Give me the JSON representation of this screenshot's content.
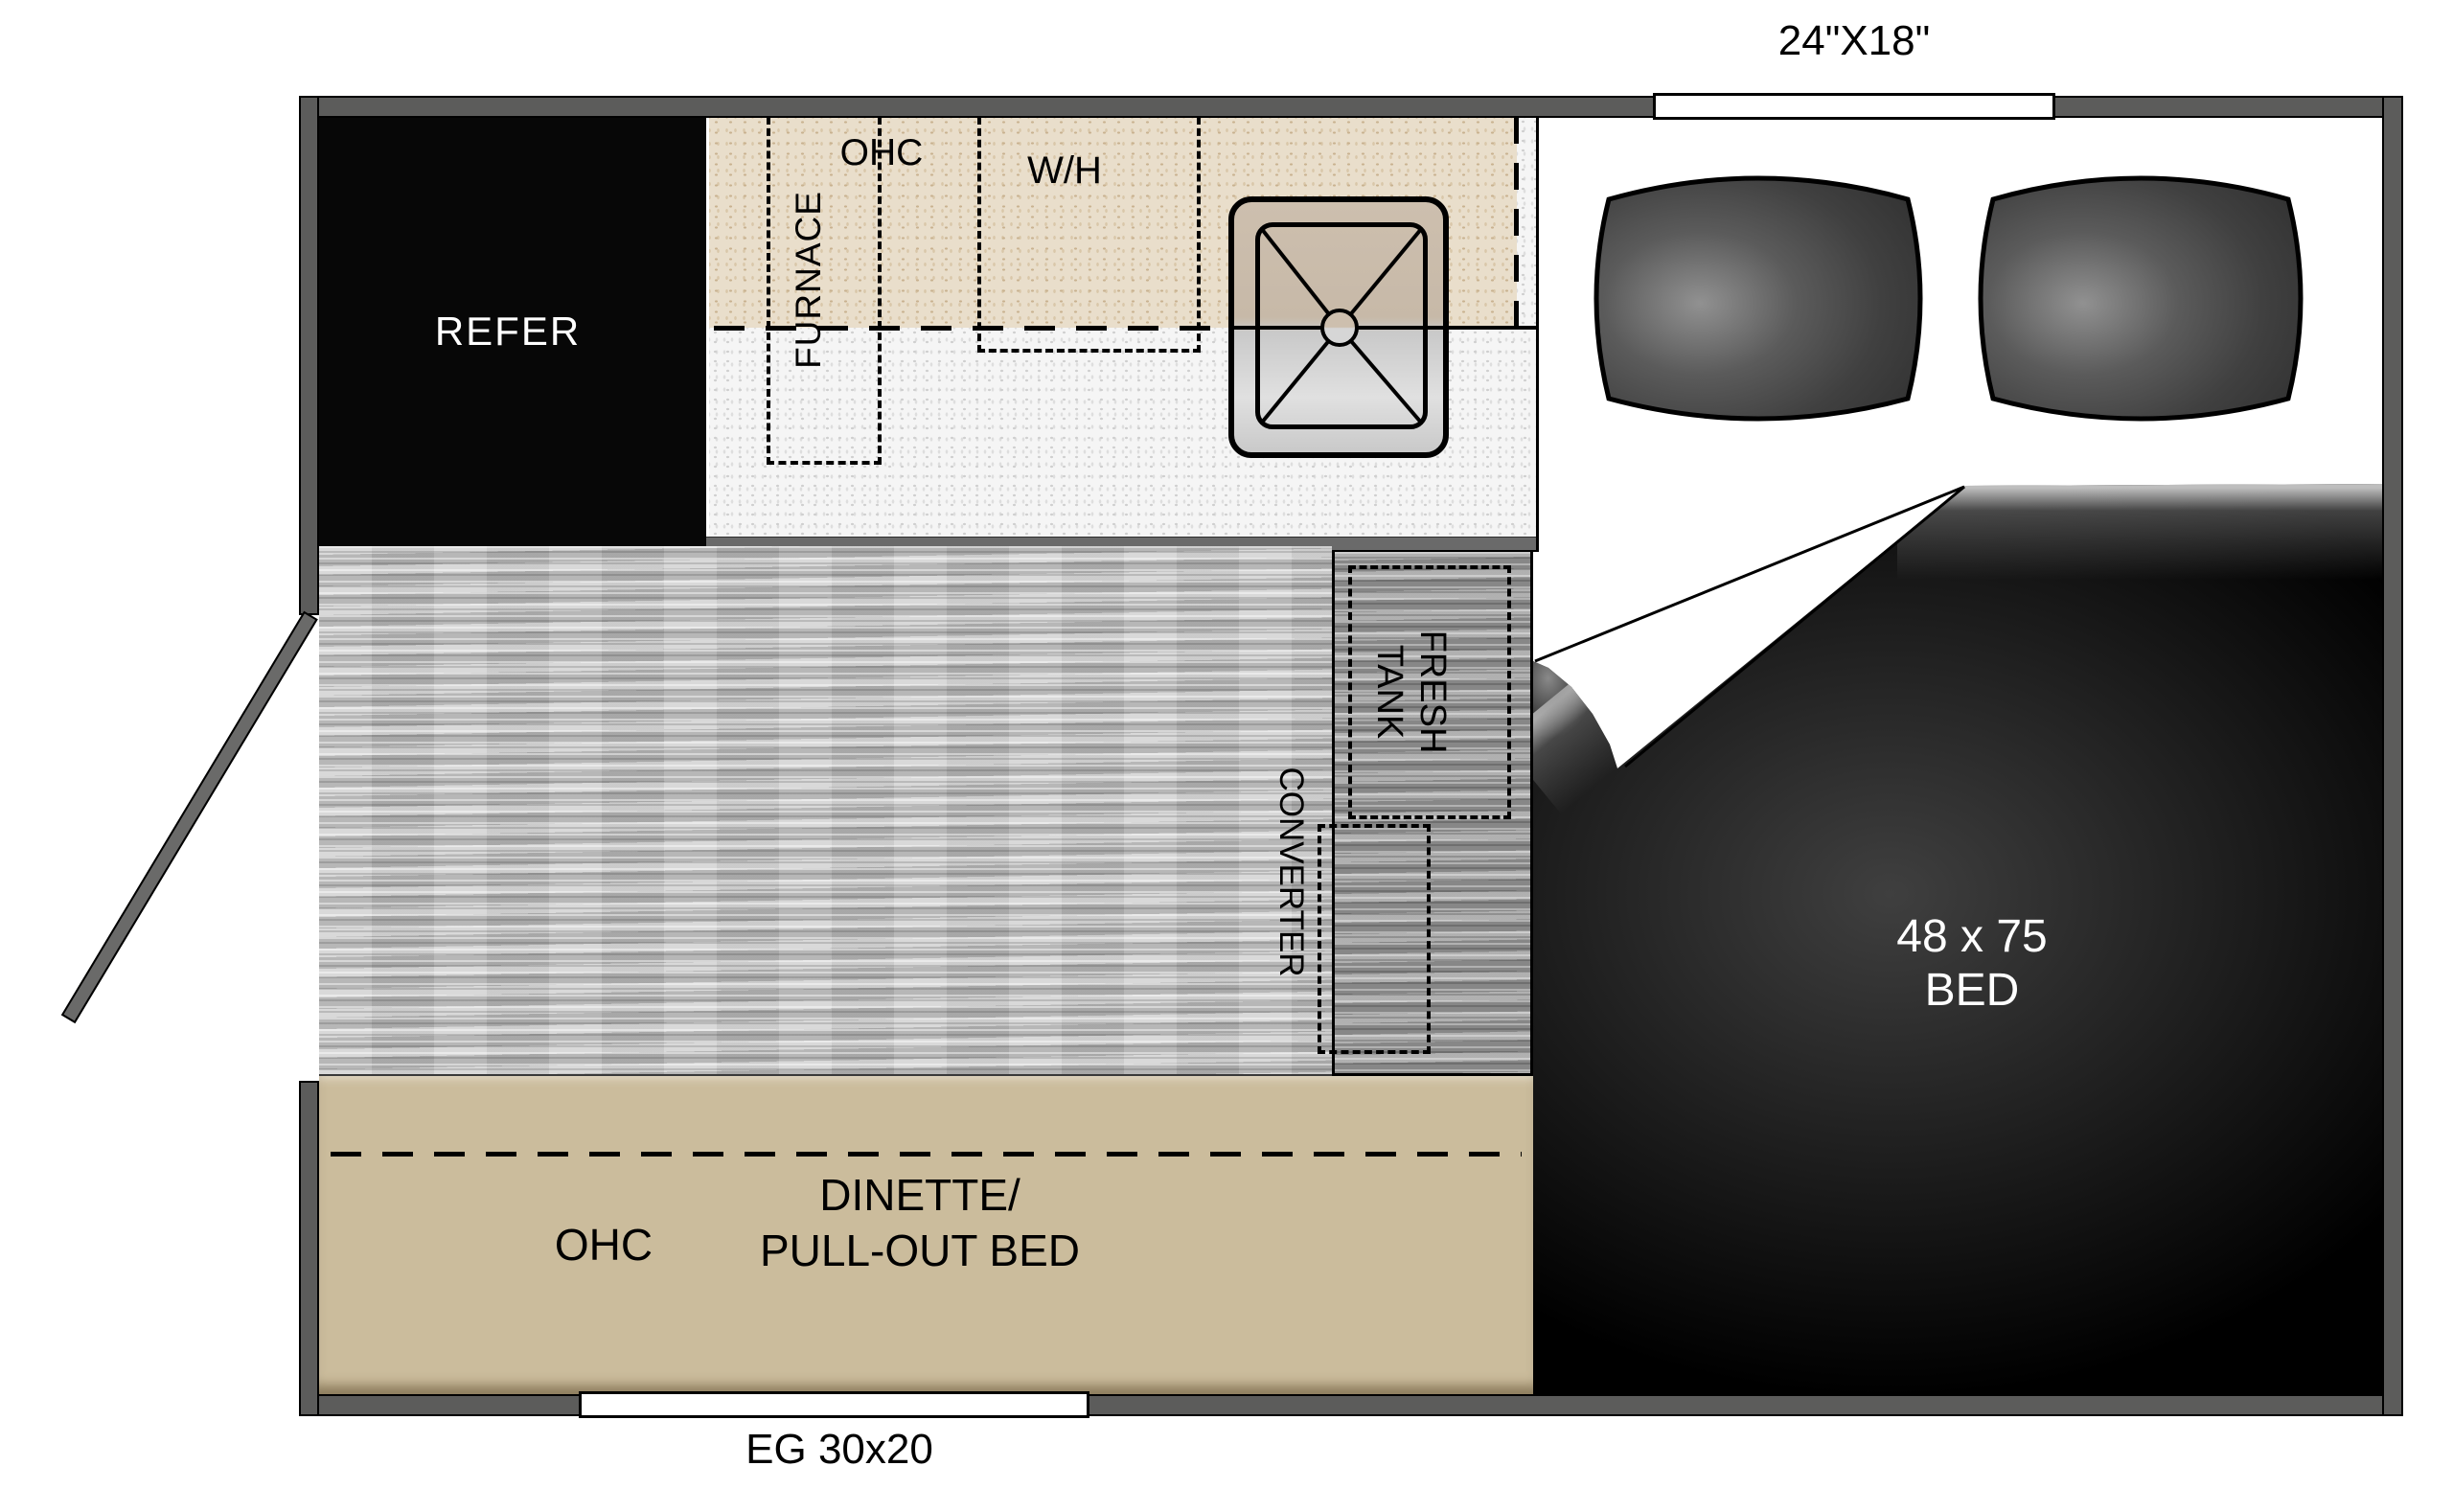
{
  "plan": {
    "type": "travel-trailer floor plan",
    "window_top_label": "24\"X18\"",
    "window_bottom_label": "EG 30x20",
    "refrigerator": "REFER",
    "furnace": "FURNACE",
    "kitchen_ohc": "OHC",
    "water_heater": "W/H",
    "fresh_tank_line1": "FRESH",
    "fresh_tank_line2": "TANK",
    "converter": "CONVERTER",
    "bed_size": "48 x 75",
    "bed": "BED",
    "dinette_ohc": "OHC",
    "dinette_line1": "DINETTE/",
    "dinette_line2": "PULL-OUT BED"
  },
  "colors": {
    "wall": "#5c5c5b",
    "cabinet_tan": "#e9decb",
    "countertop": "#f5f5f5",
    "floor": "#c6c6c6",
    "utility_platform": "#9d9d9d",
    "dinette": "#cbbc9c",
    "bed": "#000000",
    "cushion": "#4a4a4a",
    "label_white": "#ffffff",
    "label_black": "#000000"
  }
}
